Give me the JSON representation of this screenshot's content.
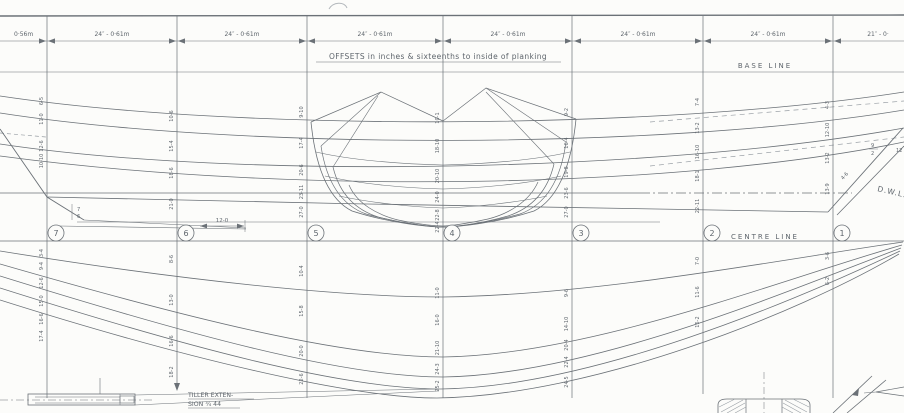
{
  "meta": {
    "sheet": "boat lines plan (profile and half-breadth) with offsets",
    "ink_color": "#6b7177",
    "paper_color": "#fcfcfa",
    "width_px": 904,
    "height_px": 413
  },
  "notes": {
    "offsets_note": "OFFSETS   in inches & sixteenths  to inside  of planking",
    "base_line": "BASE  LINE",
    "centre_line": "CENTRE  LINE",
    "dwl": "D.W.L.",
    "tiller_1": "TILLER EXTEN-",
    "tiller_2": "SION  ¾  44",
    "case_dim": "12-0",
    "transom_dim_top": "7",
    "transom_dim_bot": "6",
    "stem_frac_top": "9",
    "stem_frac_bot": "2",
    "stem_label": "4-6",
    "edge_label": "12"
  },
  "dimension_row": {
    "y_line": 41,
    "y_label": 36,
    "segments": [
      {
        "x1": -80,
        "x2": 47,
        "label": "0·56m",
        "label_x": 14
      },
      {
        "x1": 47,
        "x2": 177,
        "label": "24″ - 0·61m"
      },
      {
        "x1": 177,
        "x2": 307,
        "label": "24″ - 0·61m"
      },
      {
        "x1": 307,
        "x2": 443,
        "label": "24″ - 0·61m"
      },
      {
        "x1": 443,
        "x2": 573,
        "label": "24″ - 0·61m"
      },
      {
        "x1": 573,
        "x2": 703,
        "label": "24″ - 0·61m"
      },
      {
        "x1": 703,
        "x2": 833,
        "label": "24″ - 0·61m"
      },
      {
        "x1": 833,
        "x2": 960,
        "label": "21″ - 0·",
        "label_x": 878
      }
    ]
  },
  "stations": [
    {
      "num": "7",
      "x": 47,
      "y1": 16,
      "y2": 398,
      "arrow": false
    },
    {
      "num": "6",
      "x": 177,
      "y1": 16,
      "y2": 383,
      "arrow": true
    },
    {
      "num": "5",
      "x": 307,
      "y1": 16,
      "y2": 398,
      "arrow": false
    },
    {
      "num": "4",
      "x": 443,
      "y1": 16,
      "y2": 398,
      "arrow": false
    },
    {
      "num": "3",
      "x": 572,
      "y1": 16,
      "y2": 398,
      "arrow": false
    },
    {
      "num": "2",
      "x": 703,
      "y1": 16,
      "y2": 394,
      "arrow": false
    },
    {
      "num": "1",
      "x": 833,
      "y1": 16,
      "y2": 398,
      "arrow": false
    }
  ],
  "circle_row_y": 233,
  "offset_columns": [
    {
      "x": 47,
      "items": [
        {
          "v": "6-5",
          "y": 101
        },
        {
          "v": "11-0",
          "y": 119
        },
        {
          "v": "12-6",
          "y": 146
        },
        {
          "v": "10-10",
          "y": 161
        },
        {
          "v": "3-4",
          "y": 253
        },
        {
          "v": "9-4",
          "y": 266
        },
        {
          "v": "12-6",
          "y": 283
        },
        {
          "v": "15-0",
          "y": 301
        },
        {
          "v": "16-6",
          "y": 319
        },
        {
          "v": "17-4",
          "y": 336
        }
      ]
    },
    {
      "x": 177,
      "items": [
        {
          "v": "10-6",
          "y": 116
        },
        {
          "v": "15-4",
          "y": 146
        },
        {
          "v": "18-6",
          "y": 173
        },
        {
          "v": "21-0",
          "y": 204
        },
        {
          "v": "8-6",
          "y": 259
        },
        {
          "v": "13-0",
          "y": 300
        },
        {
          "v": "16-6",
          "y": 341
        },
        {
          "v": "18-2",
          "y": 372
        }
      ]
    },
    {
      "x": 307,
      "items": [
        {
          "v": "9-10",
          "y": 112
        },
        {
          "v": "17-4",
          "y": 143
        },
        {
          "v": "20-6",
          "y": 170
        },
        {
          "v": "23-11",
          "y": 192
        },
        {
          "v": "27-0",
          "y": 212
        },
        {
          "v": "10-4",
          "y": 271
        },
        {
          "v": "15-8",
          "y": 311
        },
        {
          "v": "20-0",
          "y": 351
        },
        {
          "v": "22-6",
          "y": 379
        }
      ]
    },
    {
      "x": 443,
      "items": [
        {
          "v": "10-1",
          "y": 118
        },
        {
          "v": "18-10",
          "y": 146
        },
        {
          "v": "20-10",
          "y": 176
        },
        {
          "v": "24-0",
          "y": 197
        },
        {
          "v": "22-8",
          "y": 215
        },
        {
          "v": "22-4",
          "y": 227
        },
        {
          "v": "11-0",
          "y": 293
        },
        {
          "v": "16-0",
          "y": 320
        },
        {
          "v": "21-10",
          "y": 348
        },
        {
          "v": "24-3",
          "y": 369
        },
        {
          "v": "25-2",
          "y": 386
        }
      ]
    },
    {
      "x": 572,
      "items": [
        {
          "v": "9-2",
          "y": 112
        },
        {
          "v": "16-4",
          "y": 143
        },
        {
          "v": "19-8",
          "y": 172
        },
        {
          "v": "23-6",
          "y": 193
        },
        {
          "v": "27-0",
          "y": 212
        },
        {
          "v": "9-6",
          "y": 293
        },
        {
          "v": "14-10",
          "y": 324
        },
        {
          "v": "20-4",
          "y": 345
        },
        {
          "v": "22-4",
          "y": 362
        },
        {
          "v": "24-5",
          "y": 382
        }
      ]
    },
    {
      "x": 703,
      "items": [
        {
          "v": "7-4",
          "y": 102
        },
        {
          "v": "13-2",
          "y": 128
        },
        {
          "v": "16-10",
          "y": 152
        },
        {
          "v": "18-1",
          "y": 176
        },
        {
          "v": "22-11",
          "y": 206
        },
        {
          "v": "7-0",
          "y": 261
        },
        {
          "v": "11-6",
          "y": 292
        },
        {
          "v": "15-2",
          "y": 322
        }
      ]
    },
    {
      "x": 833,
      "items": [
        {
          "v": "4-3",
          "y": 105
        },
        {
          "v": "12-10",
          "y": 130
        },
        {
          "v": "13-2",
          "y": 158
        },
        {
          "v": "13-9",
          "y": 189
        },
        {
          "v": "3-6",
          "y": 256
        },
        {
          "v": "6-2",
          "y": 281
        }
      ]
    }
  ]
}
